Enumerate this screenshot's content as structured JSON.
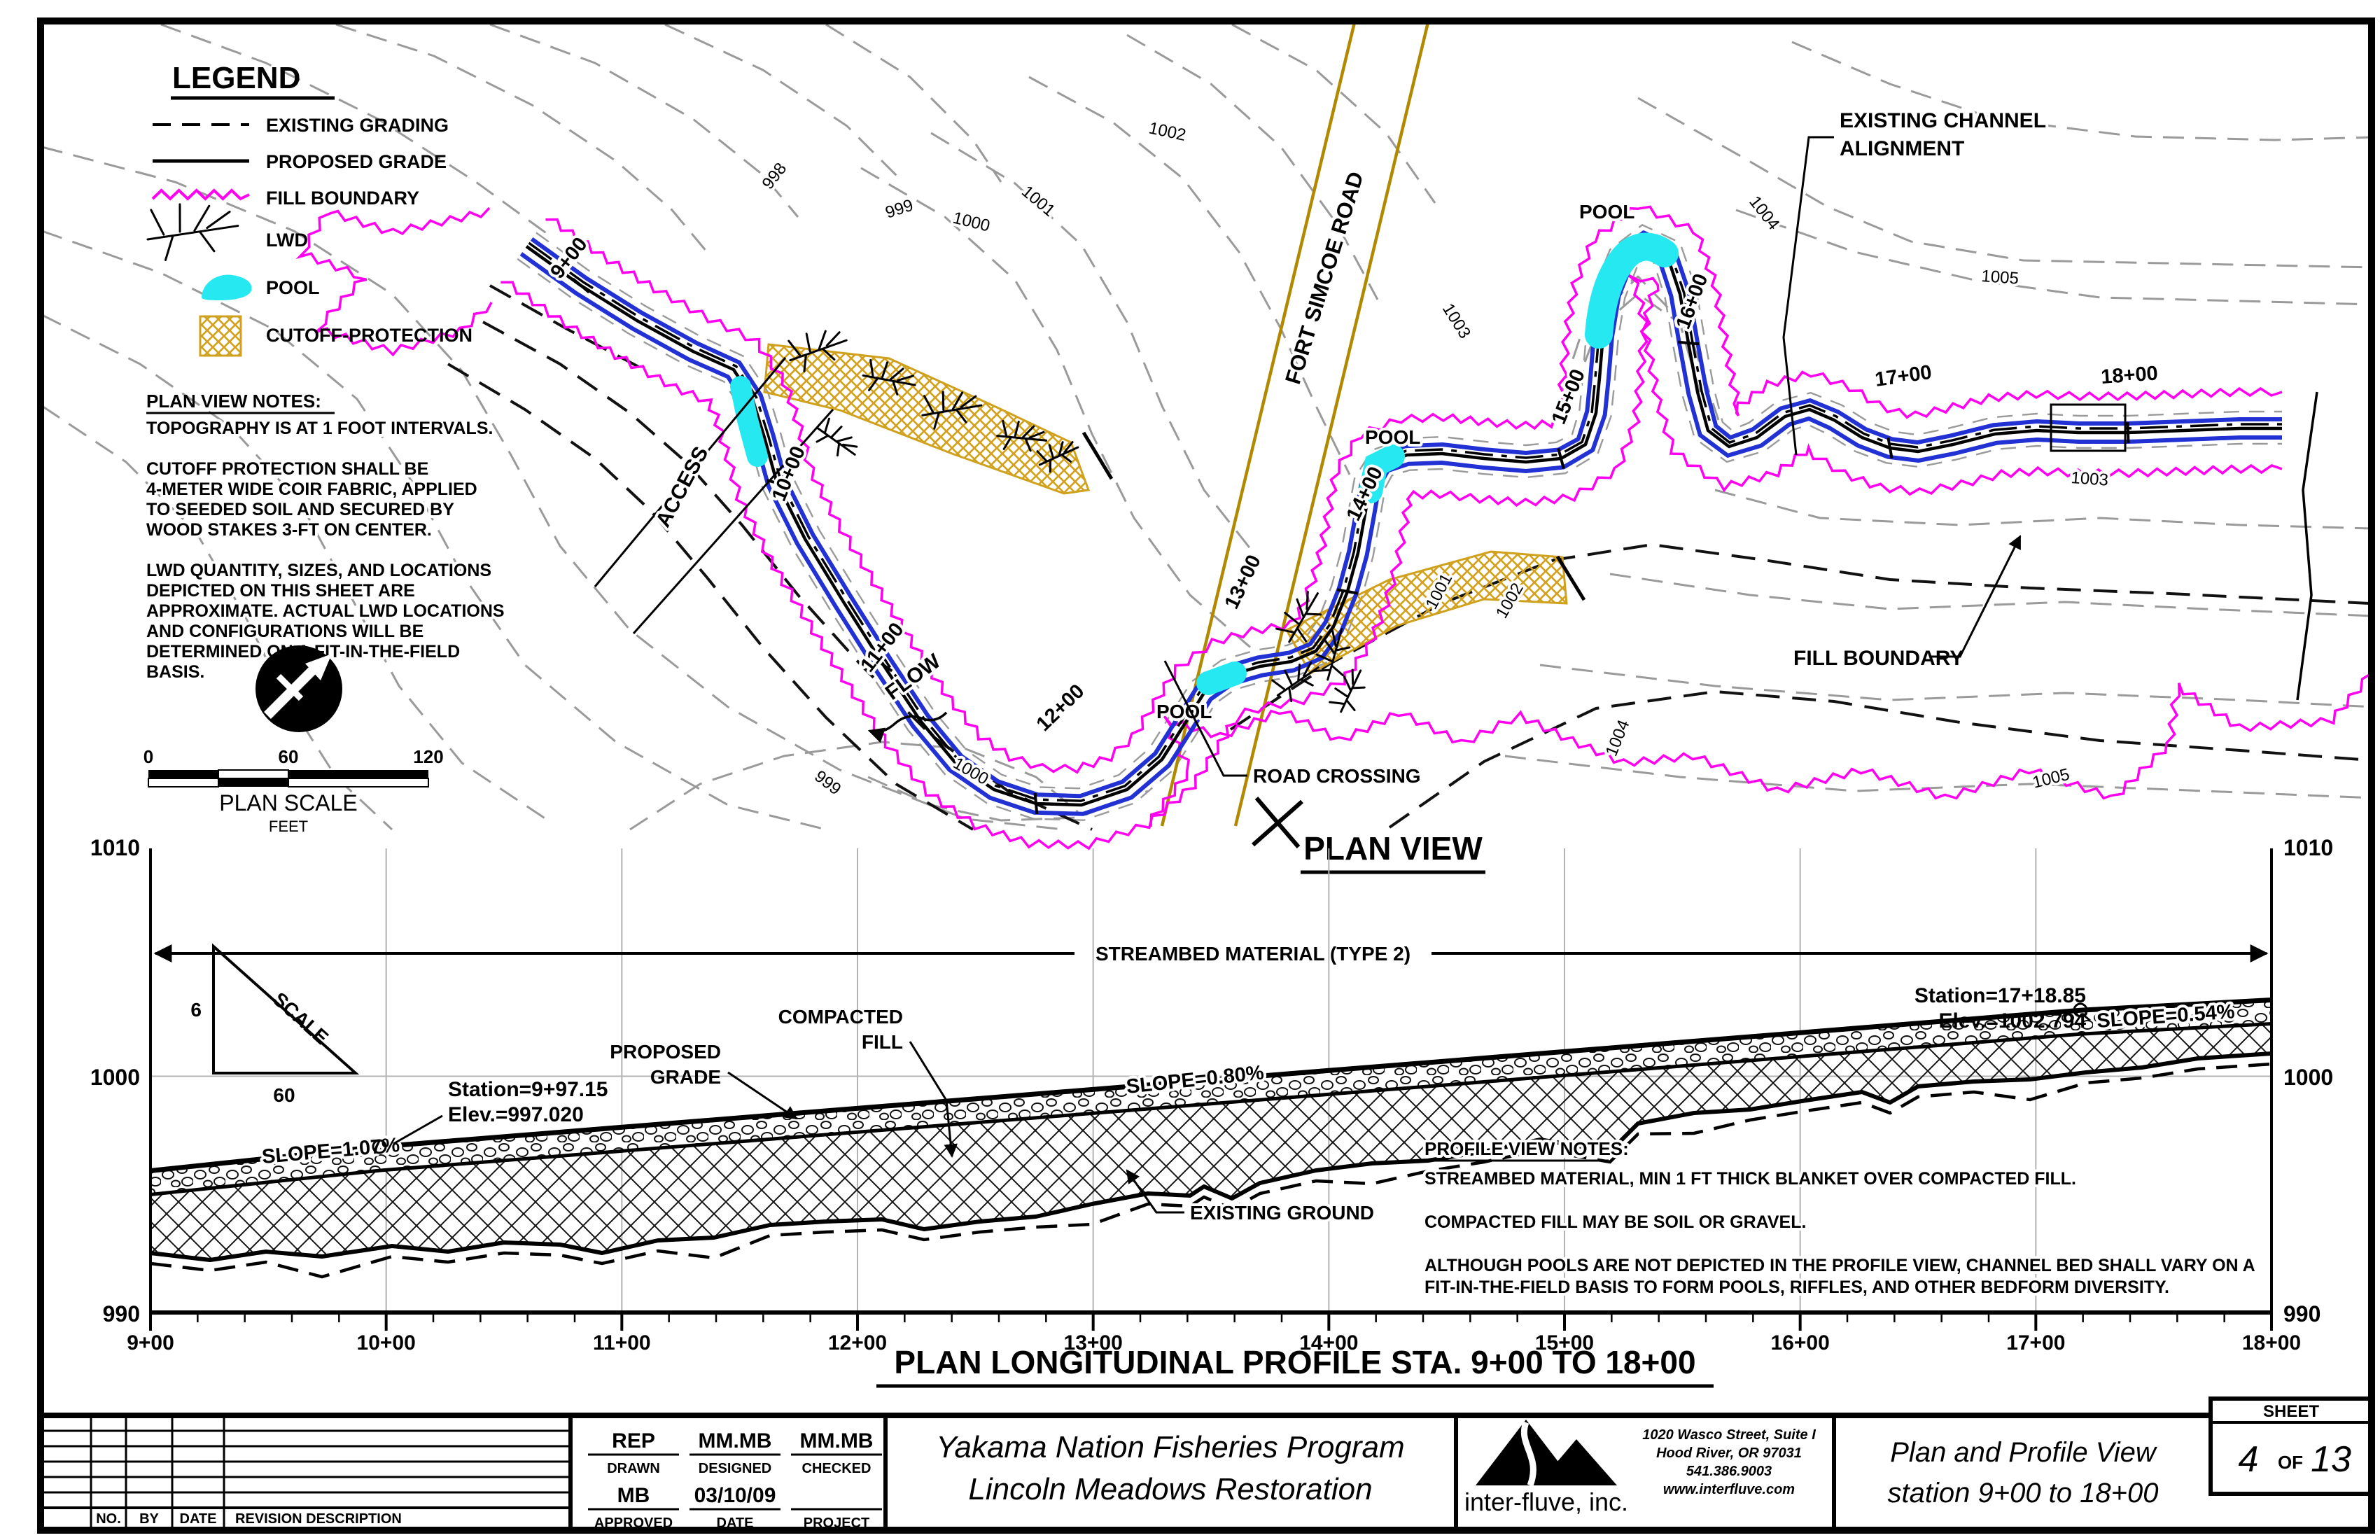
{
  "colors": {
    "magenta": "#ff00f0",
    "blue": "#2231d4",
    "cyan": "#26e8f0",
    "gold": "#d0a11c",
    "road_olive": "#b08900",
    "contour_gray": "#9a9a9a"
  },
  "legend": {
    "title": "LEGEND",
    "items": [
      {
        "label": "EXISTING GRADING",
        "symbol": "dashed-line"
      },
      {
        "label": "PROPOSED GRADE",
        "symbol": "solid-line"
      },
      {
        "label": "FILL BOUNDARY",
        "symbol": "magenta-zigzag"
      },
      {
        "label": "LWD",
        "symbol": "branch"
      },
      {
        "label": "POOL",
        "symbol": "cyan-blob"
      },
      {
        "label": "CUTOFF-PROTECTION",
        "symbol": "gold-crosshatch"
      }
    ]
  },
  "plan_notes": {
    "title": "PLAN VIEW NOTES:",
    "lines": [
      "TOPOGRAPHY IS AT 1 FOOT INTERVALS.",
      "",
      "CUTOFF PROTECTION SHALL BE",
      "4-METER WIDE COIR FABRIC, APPLIED",
      "TO SEEDED SOIL AND SECURED BY",
      "WOOD STAKES 3-FT ON CENTER.",
      "",
      "LWD QUANTITY, SIZES, AND LOCATIONS",
      "DEPICTED ON THIS SHEET ARE",
      "APPROXIMATE. ACTUAL LWD LOCATIONS",
      "AND CONFIGURATIONS WILL BE",
      "DETERMINED ON A FIT-IN-THE-FIELD",
      "BASIS."
    ]
  },
  "plan_scale": {
    "tick0": "0",
    "tick60": "60",
    "tick120": "120",
    "label": "PLAN SCALE",
    "units": "FEET"
  },
  "stations": [
    "9+00",
    "10+00",
    "11+00",
    "12+00",
    "13+00",
    "14+00",
    "15+00",
    "16+00",
    "17+00",
    "18+00"
  ],
  "plan": {
    "title": "PLAN VIEW",
    "road_label": "FORT SIMCOE ROAD",
    "access_label": "ACCESS",
    "flow_label": "FLOW",
    "pool_label": "POOL",
    "road_crossing_label": "ROAD CROSSING",
    "existing_channel_line1": "EXISTING CHANNEL",
    "existing_channel_line2": "ALIGNMENT",
    "fill_boundary_label": "FILL BOUNDARY",
    "contour_labels": [
      "998",
      "999",
      "1000",
      "1001",
      "1002",
      "999",
      "1000",
      "1001",
      "1002",
      "1003",
      "1003",
      "1004",
      "1004",
      "1005",
      "1005"
    ]
  },
  "profile": {
    "title": "PLAN LONGITUDINAL PROFILE STA. 9+00 TO 18+00",
    "elev_top": "1010",
    "elev_mid": "1000",
    "elev_bot": "990",
    "dim_label": "STREAMBED MATERIAL (TYPE 2)",
    "proposed_grade_line1": "PROPOSED",
    "proposed_grade_line2": "GRADE",
    "compacted_fill_line1": "COMPACTED",
    "compacted_fill_line2": "FILL",
    "existing_ground_label": "EXISTING GROUND",
    "slope1": "SLOPE=1.07%",
    "slope2": "SLOPE=0.80%",
    "slope3": "SLOPE=0.54%",
    "bp1_station": "Station=9+97.15",
    "bp1_elev": "Elev.=997.020",
    "bp2_station": "Station=17+18.85",
    "bp2_elev": "Elev.=1002.794",
    "scale_triangle": {
      "v": "6",
      "h": "60",
      "label": "SCALE"
    },
    "notes_title": "PROFILE VIEW NOTES:",
    "notes_lines": [
      "STREAMBED MATERIAL, MIN 1 FT THICK BLANKET OVER COMPACTED FILL.",
      "",
      "COMPACTED FILL MAY BE SOIL OR GRAVEL.",
      "",
      "ALTHOUGH POOLS ARE NOT DEPICTED IN THE PROFILE VIEW, CHANNEL BED SHALL VARY ON A",
      "FIT-IN-THE-FIELD BASIS TO FORM POOLS, RIFFLES, AND OTHER BEDFORM DIVERSITY."
    ],
    "profile_data": {
      "station_range": [
        "9+00",
        "18+00"
      ],
      "elev_range": [
        990,
        1010
      ],
      "breakpoints": [
        {
          "station": "9+97.15",
          "elev": 997.02
        },
        {
          "station": "17+18.85",
          "elev": 1002.794
        }
      ],
      "slopes_pct": [
        1.07,
        0.8,
        0.54
      ]
    }
  },
  "title_block": {
    "rev_headers": {
      "no": "NO.",
      "by": "BY",
      "date": "DATE",
      "desc": "REVISION DESCRIPTION"
    },
    "drawn_value": "REP",
    "drawn_label": "DRAWN",
    "designed_value": "MM.MB",
    "designed_label": "DESIGNED",
    "checked_value": "MM.MB",
    "checked_label": "CHECKED",
    "approved_value": "MB",
    "approved_label": "APPROVED",
    "date_value": "03/10/09",
    "date_label": "DATE",
    "project_value": "",
    "project_label": "PROJECT",
    "project_title_line1": "Yakama Nation Fisheries Program",
    "project_title_line2": "Lincoln Meadows Restoration",
    "company": "inter-fluve, inc.",
    "address_line1": "1020 Wasco Street, Suite I",
    "address_line2": "Hood River, OR 97031",
    "address_line3": "541.386.9003",
    "address_line4": "www.interfluve.com",
    "sheet_label": "SHEET",
    "sheet_number": "4",
    "sheet_of": "OF",
    "sheet_total": "13",
    "sheet_title_line1": "Plan and Profile View",
    "sheet_title_line2": "station 9+00 to 18+00"
  }
}
